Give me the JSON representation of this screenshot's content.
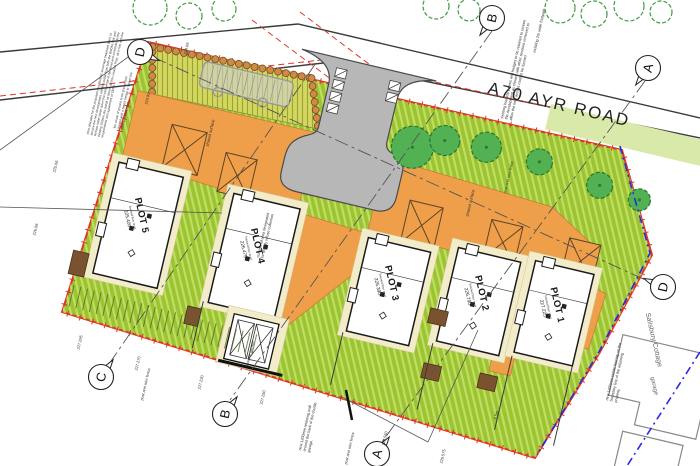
{
  "road": {
    "label": "A70   AYR ROAD"
  },
  "palette": {
    "site_green": "#9cc332",
    "grass_hatch": "#bfdf62",
    "splay": "#d3d75e",
    "orange": "#ef9f49",
    "road_grey": "#b7b7b7",
    "verge": "#d9e9a9",
    "tree": "#52b152",
    "tree_edge": "#2e7a31",
    "hedge_bead": "#cf8a4a",
    "hedge_bead_edge": "#7a4a1f",
    "boundary_red": "#e03427",
    "fence_blue": "#2a2ae0",
    "cream": "#f2ecca",
    "brown": "#7a5230",
    "ink": "#333333"
  },
  "plots": [
    {
      "name": "PLOT 5",
      "ffl_label": "finished floor level",
      "ffl": "225.400",
      "x": -2,
      "y": 126,
      "w": 66,
      "h": 114
    },
    {
      "name": "PLOT 4",
      "ffl_label": "finished floor level",
      "ffl": "226.475",
      "x": 117,
      "y": 130,
      "w": 68,
      "h": 112
    },
    {
      "name": "PLOT 3",
      "ffl_label": "finished floor level",
      "ffl": "226.390",
      "x": 258,
      "y": 142,
      "w": 64,
      "h": 96
    },
    {
      "name": "PLOT 2",
      "ffl_label": "finished floor level",
      "ffl": "226.790",
      "x": 348,
      "y": 131,
      "w": 64,
      "h": 96
    },
    {
      "name": "PLOT 1",
      "ffl_label": "finished floor level",
      "ffl": "227.225",
      "x": 426,
      "y": 126,
      "w": 60,
      "h": 94
    }
  ],
  "garages": [
    {
      "x": 41,
      "y": 77,
      "w": 36,
      "h": 44
    },
    {
      "x": 100,
      "y": 92,
      "w": 32,
      "h": 40
    },
    {
      "x": 290,
      "y": 96,
      "w": 34,
      "h": 44
    },
    {
      "x": 374,
      "y": 96,
      "w": 32,
      "h": 40
    },
    {
      "x": 454,
      "y": 96,
      "w": 32,
      "h": 40
    }
  ],
  "markers": [
    {
      "letter": "D",
      "x": 140,
      "y": 52,
      "tail_deg": 24
    },
    {
      "letter": "B",
      "x": 492,
      "y": 18,
      "tail_deg": 125
    },
    {
      "letter": "A",
      "x": 648,
      "y": 68,
      "tail_deg": 126
    },
    {
      "letter": "C",
      "x": 101,
      "y": 377,
      "tail_deg": 305
    },
    {
      "letter": "B",
      "x": 225,
      "y": 414,
      "tail_deg": 305
    },
    {
      "letter": "A",
      "x": 377,
      "y": 454,
      "tail_deg": 306
    },
    {
      "letter": "D",
      "x": 663,
      "y": 287,
      "tail_deg": 204
    }
  ],
  "annotations": [
    {
      "name": "note-biodisc",
      "text": "area allocated for the proposed new BioDisc sewerage treatment plant, to service the new development with the outfall from both the BioDisc unit and surface water taken down the west verge of Ayr Road and connected to the existing 150mm dia outfall as shown on the Location Plan, all in line with the requirements and agreement of SEPA",
      "x": 86,
      "y": 134,
      "rot": -77,
      "w": 112,
      "size": 3.2,
      "color": "#333"
    },
    {
      "name": "note-beech-hedge",
      "text": "the whole of ground to be graded and planted with a beech hedge to screen the plant and equipment",
      "x": 113,
      "y": 128,
      "rot": -77,
      "w": 62,
      "size": 3.2,
      "color": "#333"
    },
    {
      "name": "note-footpath",
      "text": "existing 2m wide footpath",
      "x": 532,
      "y": 52,
      "rot": -77,
      "w": 46,
      "size": 4,
      "color": "#333"
    },
    {
      "name": "note-boundary-trees",
      "text": "existing boundary trees and hedges to be retained to screen the development as shown, with other sections removed to allow the new access road to be formed",
      "x": 500,
      "y": 118,
      "rot": -77,
      "w": 104,
      "size": 3.8,
      "color": "#333"
    },
    {
      "name": "label-shared-surface-1",
      "text": "shared surface",
      "x": 205,
      "y": 146,
      "rot": -77,
      "w": 28,
      "size": 4.2,
      "color": "#333"
    },
    {
      "name": "label-shared-surface-2",
      "text": "shared surface",
      "x": 465,
      "y": 216,
      "rot": -77,
      "w": 28,
      "size": 4.2,
      "color": "#333"
    },
    {
      "name": "note-refuse",
      "text": "communal area designated for weekly refuse collection",
      "x": 256,
      "y": 257,
      "rot": -77,
      "w": 50,
      "size": 3.8,
      "color": "#333"
    },
    {
      "name": "label-post-wire-fence-1",
      "text": "post and wire fence",
      "x": 140,
      "y": 400,
      "rot": -77,
      "w": 40,
      "size": 3.8,
      "color": "#333"
    },
    {
      "name": "label-post-wire-fence-2",
      "text": "post and wire fence",
      "x": 503,
      "y": 193,
      "rot": -77,
      "w": 40,
      "size": 3.8,
      "color": "#333"
    },
    {
      "name": "label-post-wire-fence-3",
      "text": "post and wire fence",
      "x": 344,
      "y": 464,
      "rot": -77,
      "w": 40,
      "size": 3.8,
      "color": "#333"
    },
    {
      "name": "note-retaining-wall",
      "text": "new 1200mm retaining wall around the back of the double garage.",
      "x": 298,
      "y": 450,
      "rot": -77,
      "w": 56,
      "size": 3.8,
      "color": "#333"
    },
    {
      "name": "note-estate-fence",
      "text": "new 1200mm estate fencing on the boundary line of the adjoining property",
      "x": 605,
      "y": 400,
      "rot": -77,
      "w": 60,
      "size": 3.8,
      "color": "#333"
    },
    {
      "name": "label-salisbury-cottage",
      "text": "Salisbury Cottage",
      "x": 652,
      "y": 312,
      "rot": 77,
      "w": 100,
      "size": 7,
      "color": "#666"
    },
    {
      "name": "label-neighbour-garage",
      "text": "garage",
      "x": 656,
      "y": 376,
      "rot": 77,
      "w": 40,
      "size": 6,
      "color": "#666"
    },
    {
      "name": "label-double-garage",
      "text": "double garage",
      "x": 245,
      "y": 365,
      "rot": -77,
      "w": 30,
      "size": 4,
      "color": "#333"
    }
  ],
  "levels": [
    {
      "text": "224.98",
      "x": 183,
      "y": 54
    },
    {
      "text": "224.80",
      "x": 144,
      "y": 104
    },
    {
      "text": "225.06",
      "x": 52,
      "y": 172
    },
    {
      "text": "226.06",
      "x": 32,
      "y": 235
    },
    {
      "text": "227.295",
      "x": 76,
      "y": 349
    },
    {
      "text": "227.270",
      "x": 134,
      "y": 370
    },
    {
      "text": "227.230",
      "x": 197,
      "y": 389
    },
    {
      "text": "227.250",
      "x": 259,
      "y": 404
    },
    {
      "text": "226.560",
      "x": 381,
      "y": 445
    },
    {
      "text": "226.575",
      "x": 439,
      "y": 463
    },
    {
      "text": "5.5m",
      "x": 493,
      "y": 419
    }
  ],
  "trees_site": [
    {
      "x": 280,
      "y": 44,
      "r": 21
    },
    {
      "x": 310,
      "y": 30,
      "r": 15
    },
    {
      "x": 352,
      "y": 27,
      "r": 15
    },
    {
      "x": 407,
      "y": 29,
      "r": 13
    },
    {
      "x": 471,
      "y": 38,
      "r": 13
    },
    {
      "x": 513,
      "y": 43,
      "r": 11
    }
  ],
  "trees_page": [
    {
      "x": 150,
      "y": 8,
      "r": 17
    },
    {
      "x": 189,
      "y": 16,
      "r": 13
    },
    {
      "x": 224,
      "y": 9,
      "r": 12
    },
    {
      "x": 436,
      "y": 6,
      "r": 13
    },
    {
      "x": 469,
      "y": 10,
      "r": 11
    },
    {
      "x": 560,
      "y": 8,
      "r": 15
    },
    {
      "x": 594,
      "y": 14,
      "r": 13
    },
    {
      "x": 629,
      "y": 6,
      "r": 15
    },
    {
      "x": 661,
      "y": 12,
      "r": 11
    }
  ]
}
